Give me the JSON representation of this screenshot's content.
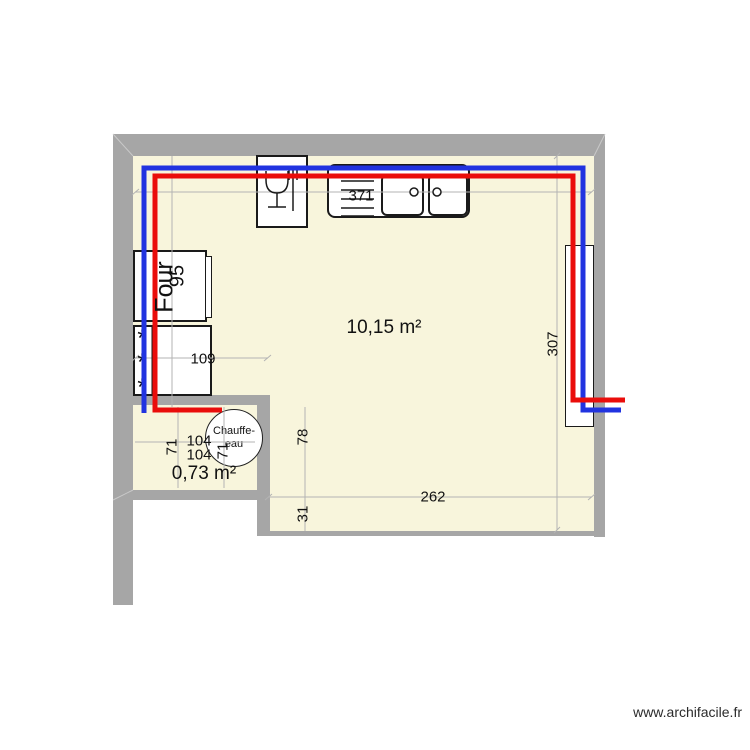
{
  "rooms": {
    "kitchen": {
      "area": "10,15 m²"
    },
    "utility": {
      "area": "0,73 m²"
    }
  },
  "dimensions": {
    "top_width": "371",
    "right_height": "307",
    "shelf_width": "109",
    "oven_run": "95",
    "utility_left": "71",
    "utility_right": "71",
    "utility_top": "104",
    "utility_bottom": "104",
    "lower_height": "78",
    "bottom_strip": "31",
    "bottom_width": "262"
  },
  "appliances": {
    "oven": "Four",
    "water_heater_line1": "Chauffe-",
    "water_heater_line2": "eau",
    "freezer_symbol": "*"
  },
  "watermark": "www.archifacile.fr",
  "colors": {
    "cold_pipe": "#2133e0",
    "hot_pipe": "#ea0d0b",
    "wall": "#a6a6a6",
    "floor": "#f8f5dc",
    "dimension_line": "#b3b3b3",
    "miter_line": "#c9c9c9",
    "ink": "#1a1a1a"
  }
}
